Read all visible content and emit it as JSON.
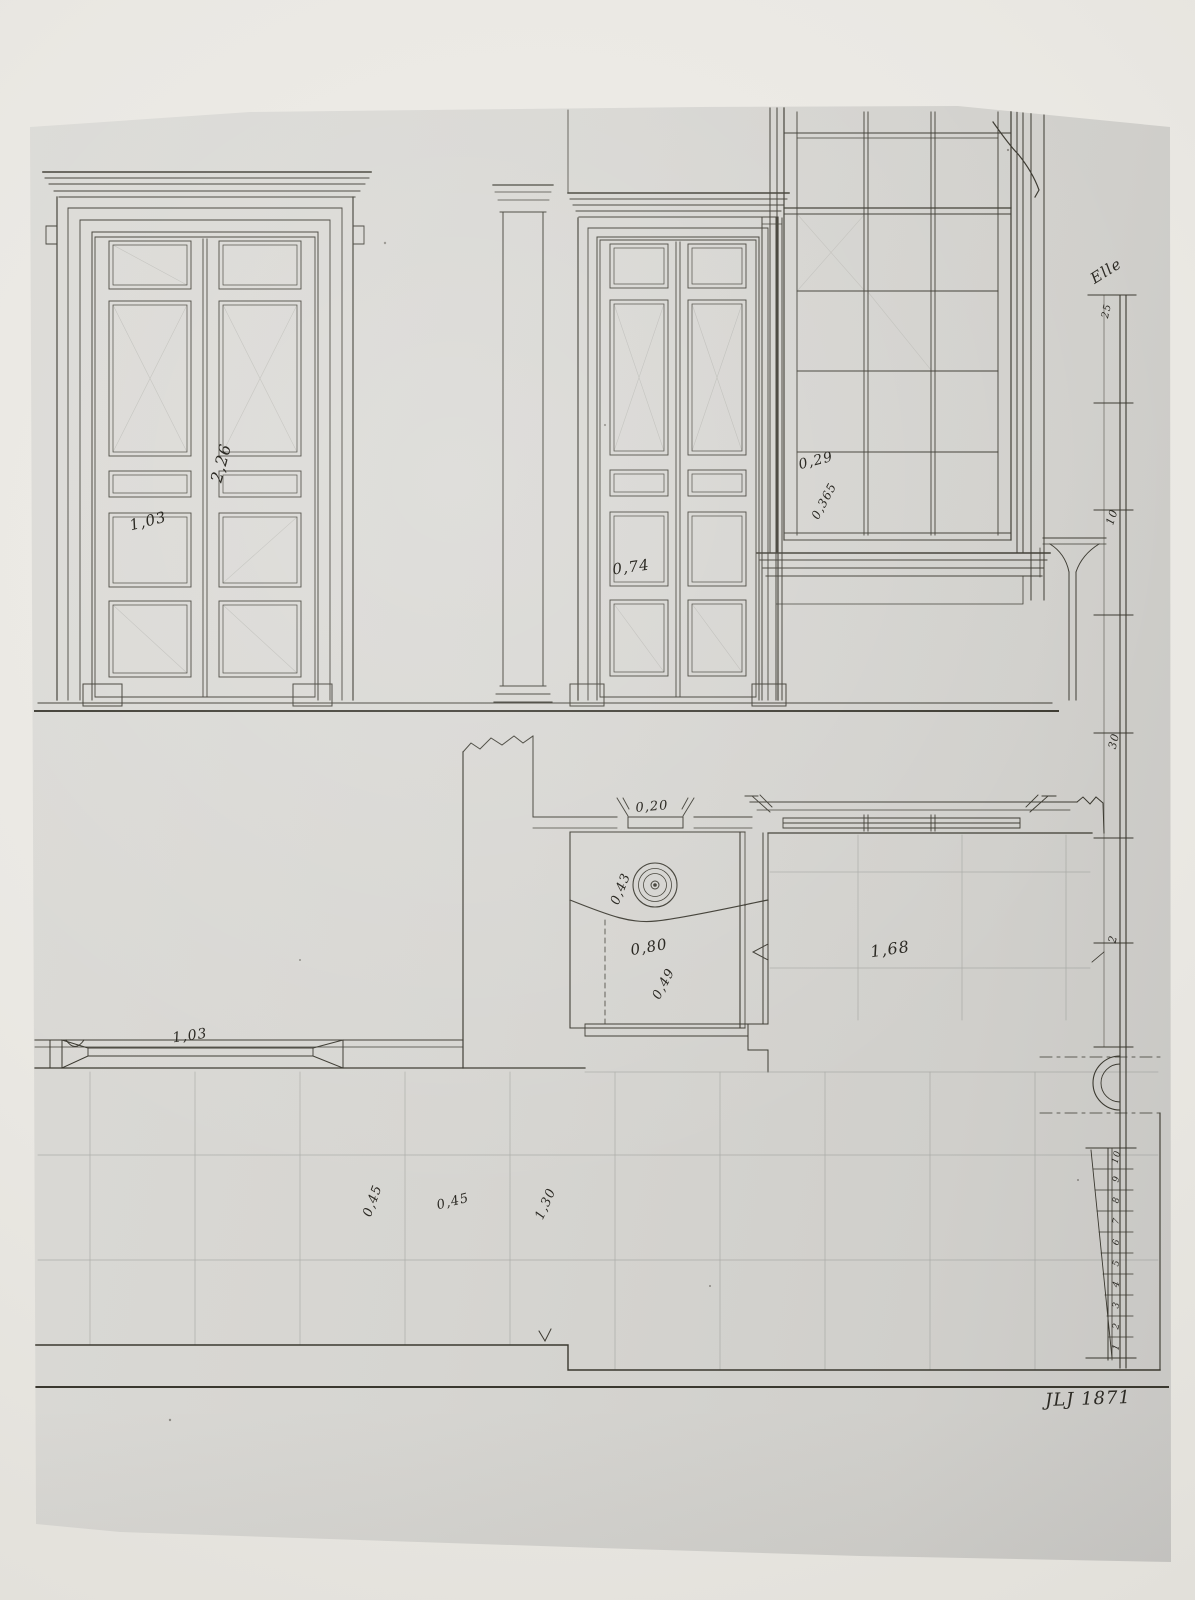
{
  "document": {
    "kind": "architectural drawing, door and window elevations with floor plan",
    "signature": "JLJ 1871"
  },
  "elevation_labels": {
    "left_door_height": "2,26",
    "left_door_width": "1,03",
    "middle_door_width": "0,74",
    "window_pane_width": "0,29",
    "window_pane_height": "0,365"
  },
  "plan_labels": {
    "flue_width": "0,20",
    "pier_dim_a": "0,43",
    "pier_dim_b": "0,80",
    "pier_dim_c": "0,49",
    "room_width": "1,68",
    "door_width": "1,03",
    "floor_tile_a": "0,45",
    "floor_tile_b": "0,45",
    "floor_tile_c": "1,30"
  },
  "ruler": {
    "unit_label": "Elle",
    "tick_labels": [
      "25",
      "10",
      "30",
      "2"
    ]
  },
  "diagonal_scale": {
    "numbers": [
      "1",
      "2",
      "3",
      "4",
      "5",
      "6",
      "7",
      "8",
      "9",
      "10"
    ]
  }
}
